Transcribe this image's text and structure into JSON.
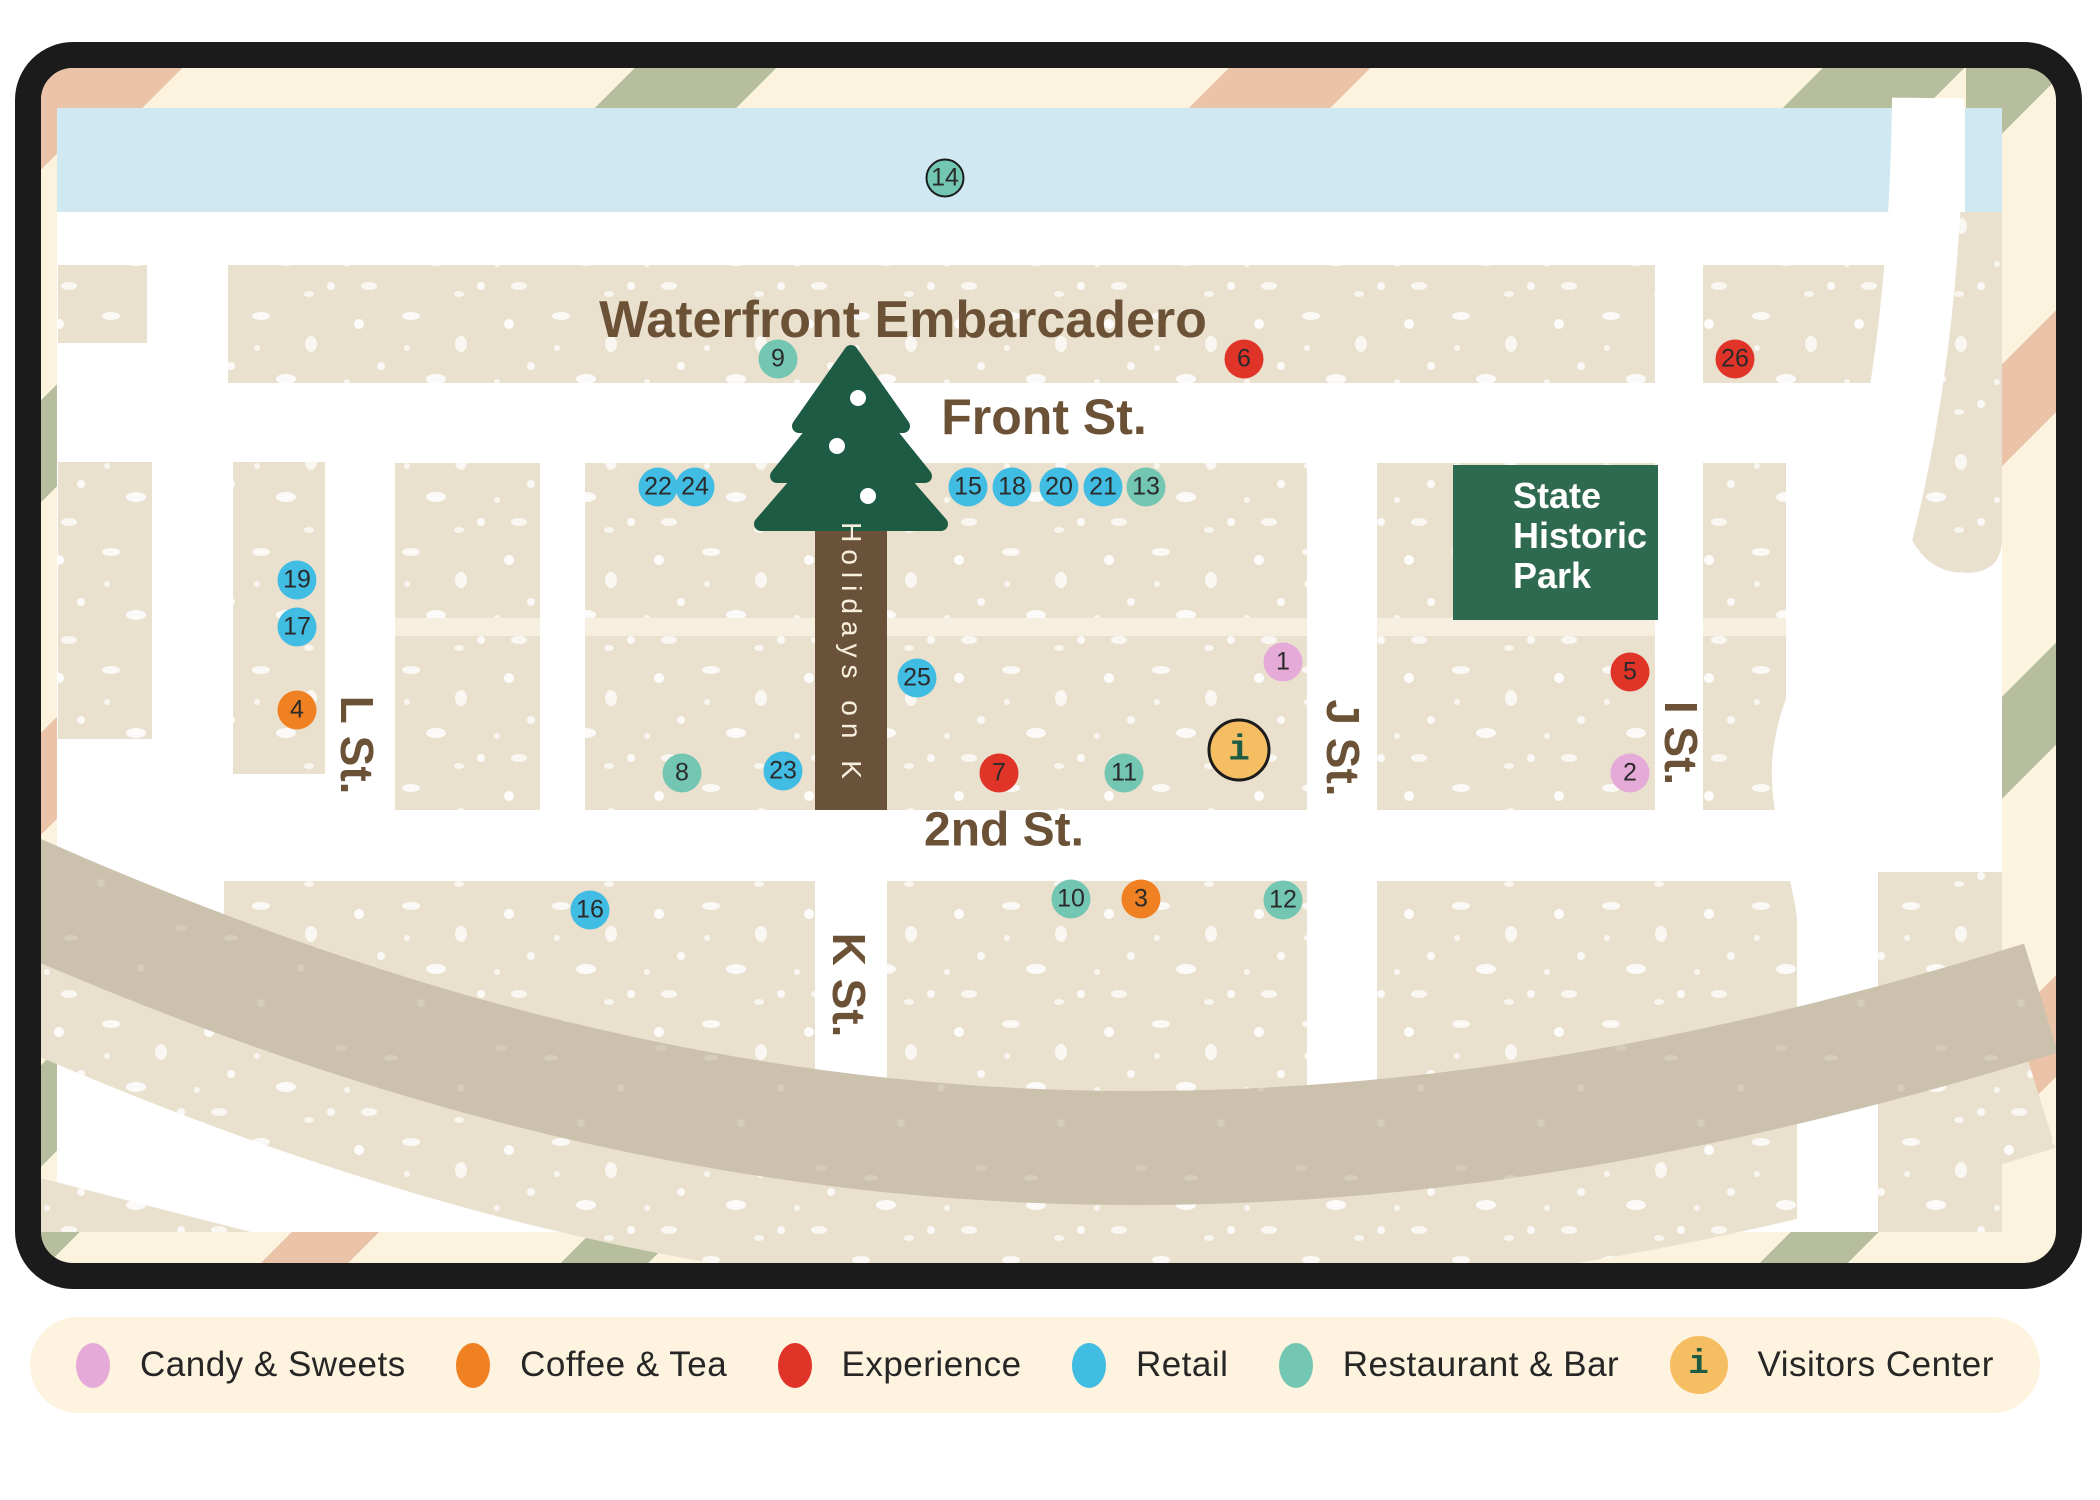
{
  "map": {
    "title": "Waterfront Embarcadero",
    "streets": {
      "front": "Front St.",
      "second": "2nd St.",
      "l": "L St.",
      "k": "K St.",
      "j": "J St.",
      "i": "I St."
    },
    "festival_label": "Holidays on K",
    "park": {
      "lines": [
        "State",
        "Historic",
        "Park"
      ]
    },
    "markers": [
      {
        "label": "1",
        "category": "candy",
        "x": 1242,
        "y": 594
      },
      {
        "label": "2",
        "category": "candy",
        "x": 1589,
        "y": 705
      },
      {
        "label": "3",
        "category": "coffee",
        "x": 1100,
        "y": 831
      },
      {
        "label": "4",
        "category": "coffee",
        "x": 256,
        "y": 642
      },
      {
        "label": "5",
        "category": "experience",
        "x": 1589,
        "y": 604
      },
      {
        "label": "6",
        "category": "experience",
        "x": 1203,
        "y": 291
      },
      {
        "label": "7",
        "category": "experience",
        "x": 958,
        "y": 705
      },
      {
        "label": "8",
        "category": "restaurant",
        "x": 641,
        "y": 705
      },
      {
        "label": "9",
        "category": "restaurant",
        "x": 737,
        "y": 291
      },
      {
        "label": "10",
        "category": "restaurant",
        "x": 1030,
        "y": 831
      },
      {
        "label": "11",
        "category": "restaurant",
        "x": 1083,
        "y": 705
      },
      {
        "label": "12",
        "category": "restaurant",
        "x": 1242,
        "y": 832
      },
      {
        "label": "13",
        "category": "restaurant",
        "x": 1105,
        "y": 419
      },
      {
        "label": "14",
        "category": "restaurant",
        "x": 904,
        "y": 110,
        "outlined": true
      },
      {
        "label": "15",
        "category": "retail",
        "x": 927,
        "y": 419
      },
      {
        "label": "16",
        "category": "retail",
        "x": 549,
        "y": 842
      },
      {
        "label": "17",
        "category": "retail",
        "x": 256,
        "y": 559
      },
      {
        "label": "18",
        "category": "retail",
        "x": 971,
        "y": 419
      },
      {
        "label": "19",
        "category": "retail",
        "x": 256,
        "y": 512
      },
      {
        "label": "20",
        "category": "retail",
        "x": 1018,
        "y": 419
      },
      {
        "label": "21",
        "category": "retail",
        "x": 1062,
        "y": 419
      },
      {
        "label": "22",
        "category": "retail",
        "x": 617,
        "y": 419
      },
      {
        "label": "23",
        "category": "retail",
        "x": 742,
        "y": 703
      },
      {
        "label": "24",
        "category": "retail",
        "x": 654,
        "y": 419
      },
      {
        "label": "25",
        "category": "retail",
        "x": 876,
        "y": 610
      },
      {
        "label": "26",
        "category": "experience",
        "x": 1694,
        "y": 291
      },
      {
        "label": "i",
        "category": "visitors",
        "x": 1198,
        "y": 682
      }
    ]
  },
  "legend": {
    "items": [
      {
        "label": "Candy & Sweets",
        "category": "candy"
      },
      {
        "label": "Coffee & Tea",
        "category": "coffee"
      },
      {
        "label": "Experience",
        "category": "experience"
      },
      {
        "label": "Retail",
        "category": "retail"
      },
      {
        "label": "Restaurant & Bar",
        "category": "restaurant"
      },
      {
        "label": "Visitors Center",
        "category": "visitors",
        "icon": "i"
      }
    ]
  },
  "colors": {
    "candy": "#E5AAD7",
    "coffee": "#F08122",
    "experience": "#E03429",
    "retail": "#41BCE2",
    "restaurant": "#72C6B2",
    "visitors": "#F6BE62",
    "water": "#D0E8F2",
    "block": "#EAE0CE",
    "alley": "#F6EFE0",
    "band": "#CBC1AD",
    "road": "#FFFFFF",
    "trunk": "#6A513A",
    "tree": "#1E5B44",
    "park": "#2E6A50",
    "label_brown": "#6B5237",
    "stripe_pink": "#EBC3A8",
    "stripe_sage": "#B7BE9D",
    "cream": "#FCF3DE",
    "border": "#1B1B1B"
  }
}
